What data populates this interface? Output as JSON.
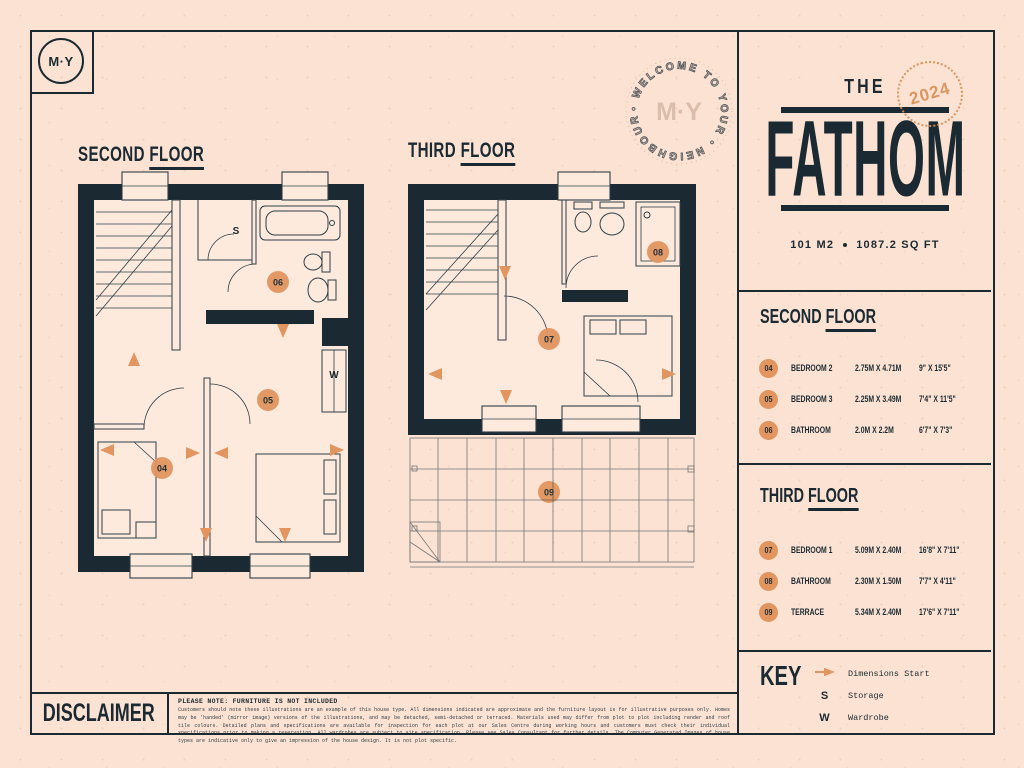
{
  "colors": {
    "ink": "#1b2a32",
    "orange": "#e2955e",
    "background": "#fbe2d2",
    "stamp_faded": "#d6b7a5",
    "stamp_orange": "#da9157"
  },
  "brand": {
    "logo": "M·Y",
    "stamp_text": "• WELCOME TO YOUR • NEIGHBOURHOOD",
    "stamp_center": "M·Y"
  },
  "title_block": {
    "the": "THE",
    "name": "FATHOM",
    "year": "2024",
    "area_metric": "101 M2",
    "area_imperial": "1087.2 SQ FT"
  },
  "plan_titles": {
    "second_w1": "SECOND",
    "second_w2": "FLOOR",
    "third_w1": "THIRD",
    "third_w2": "FLOOR"
  },
  "plan_labels": {
    "storage": "S",
    "wardrobe": "W",
    "b04": "04",
    "b05": "05",
    "b06": "06",
    "b07": "07",
    "b08": "08",
    "b09": "09"
  },
  "floors": [
    {
      "heading_w1": "SECOND",
      "heading_w2": "FLOOR",
      "rows": [
        {
          "num": "04",
          "name": "BEDROOM 2",
          "metric": "2.75M X 4.71M",
          "imperial": "9\" X 15'5\""
        },
        {
          "num": "05",
          "name": "BEDROOM 3",
          "metric": "2.25M X 3.49M",
          "imperial": "7'4\" X 11'5\""
        },
        {
          "num": "06",
          "name": "BATHROOM",
          "metric": "2.0M X 2.2M",
          "imperial": "6'7\" X 7'3\""
        }
      ]
    },
    {
      "heading_w1": "THIRD",
      "heading_w2": "FLOOR",
      "rows": [
        {
          "num": "07",
          "name": "BEDROOM 1",
          "metric": "5.09M X 2.40M",
          "imperial": "16'8\" X 7'11\""
        },
        {
          "num": "08",
          "name": "BATHROOM",
          "metric": "2.30M X 1.50M",
          "imperial": "7'7\" X 4'11\""
        },
        {
          "num": "09",
          "name": "TERRACE",
          "metric": "5.34M X 2.40M",
          "imperial": "17'6\" X 7'11\""
        }
      ]
    }
  ],
  "key": {
    "heading": "KEY",
    "items": [
      {
        "symbol": "",
        "label": "Dimensions Start"
      },
      {
        "symbol": "S",
        "label": "Storage"
      },
      {
        "symbol": "W",
        "label": "Wardrobe"
      }
    ]
  },
  "disclaimer": {
    "heading": "DISCLAIMER",
    "note_title": "PLEASE NOTE: FURNITURE IS NOT INCLUDED",
    "body": "Customers should note these illustrations are an example of this house type. All dimensions indicated are approximate and the furniture layout is for illustrative purposes only. Homes may be 'handed' (mirror image) versions of the illustrations, and may be detached, semi-detached or terraced. Materials used may differ from plot to plot including render and roof tile colours. Detailed plans and specifications are available for inspection for each plot at our Sales Centre during working hours and customers must check their individual specifications prior to making a reservation. All wardrobes are subject to site specification. Please see Sales Consultant for further details. The Computer Generated Images of house types are indicative only to give an impression of the house design. It is not plot specific."
  }
}
